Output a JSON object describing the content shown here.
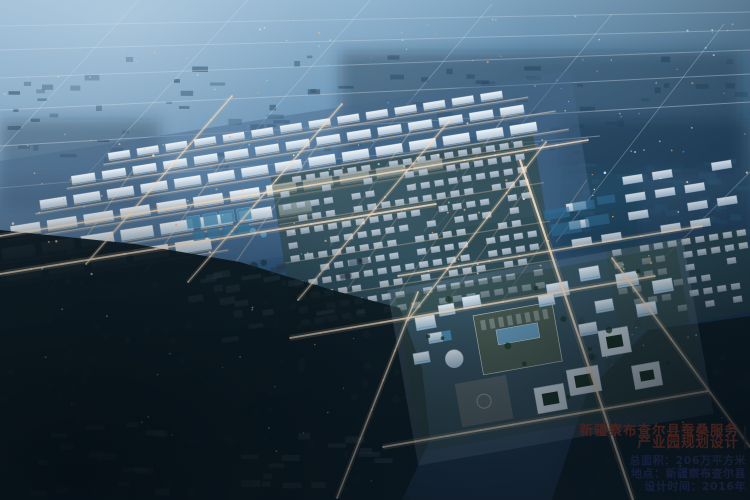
{
  "caption": {
    "title_line1": "新疆察布查尔县蚕桑服务",
    "title_line2": "产业园规划设计",
    "stats": [
      "总面积：206万平方米",
      "地点：新疆察布查尔县",
      "设计时间：2016年"
    ]
  },
  "scene": {
    "colors": {
      "sky_haze": "#9fc0d8",
      "mid_blue": "#2e5a82",
      "deep_blue": "#13293f",
      "forest_dark": "#0d1b22",
      "building_light": "#e8f1f8",
      "factory_roof_green": "#4d5f55",
      "pond_blue": "#4d8fb5",
      "road_warm": "#f4dcc2",
      "title_text": "#4a241e",
      "stats_text": "#182240"
    }
  }
}
